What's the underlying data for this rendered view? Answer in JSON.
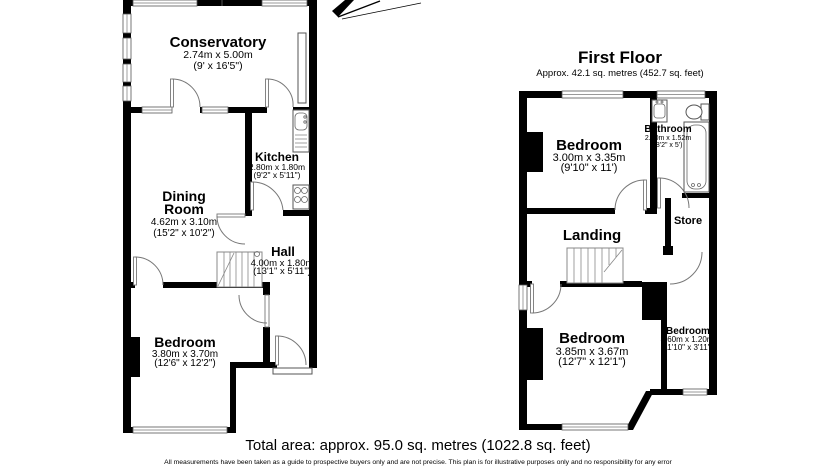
{
  "plan_colors": {
    "wall": "#000000",
    "background": "#ffffff",
    "detail_line": "#666666"
  },
  "ground": {
    "conservatory": {
      "name": "Conservatory",
      "dims_m": "2.74m x 5.00m",
      "dims_ft": "(9' x 16'5\")"
    },
    "kitchen": {
      "name": "Kitchen",
      "dims_m": "2.80m x 1.80m",
      "dims_ft": "(9'2\" x 5'11\")"
    },
    "dining_room": {
      "name1": "Dining",
      "name2": "Room",
      "dims_m": "4.62m x 3.10m",
      "dims_ft": "(15'2\" x 10'2\")"
    },
    "hall": {
      "name": "Hall",
      "dims_m": "4.00m x 1.80m",
      "dims_ft": "(13'1\" x 5'11\")"
    },
    "bedroom": {
      "name": "Bedroom",
      "dims_m": "3.80m x 3.70m",
      "dims_ft": "(12'6\" x 12'2\")"
    }
  },
  "first": {
    "title": "First Floor",
    "subtitle": "Approx. 42.1 sq. metres (452.7 sq. feet)",
    "bedroom1": {
      "name": "Bedroom",
      "dims_m": "3.00m x 3.35m",
      "dims_ft": "(9'10\" x 11')"
    },
    "bathroom": {
      "name": "Bathroom",
      "dims_m": "2.50m x 1.52m",
      "dims_ft": "(8'2\" x 5')"
    },
    "store": {
      "name": "Store"
    },
    "landing": {
      "name": "Landing"
    },
    "bedroom2": {
      "name": "Bedroom",
      "dims_m": "3.85m x 3.67m",
      "dims_ft": "(12'7\" x 12'1\")"
    },
    "bedroom3": {
      "name": "Bedroom",
      "dims_m": "3.60m x 1.20m",
      "dims_ft": "11'10\" x 3'11\""
    }
  },
  "footer": {
    "total_area": "Total area: approx. 95.0 sq. metres (1022.8 sq. feet)",
    "disclaimer": "All measurements have been taken as a guide to prospective buyers only and are not precise. This plan is for illustrative purposes only and no responsibility for any error"
  }
}
